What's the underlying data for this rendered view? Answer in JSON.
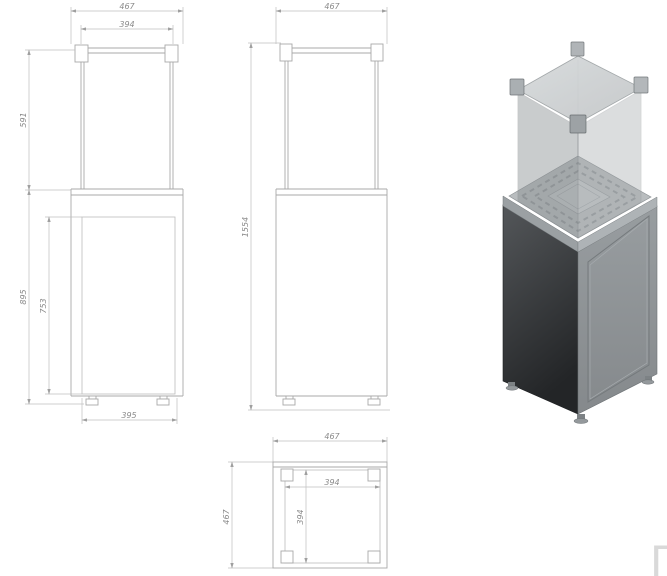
{
  "drawing": {
    "front_view": {
      "width_total": "467",
      "width_glass": "394",
      "height_glass": "591",
      "height_base": "895",
      "height_door": "753",
      "width_base": "395"
    },
    "side_view": {
      "width_total": "467",
      "height_total": "1554"
    },
    "plan_view": {
      "width_total": "467",
      "depth_total": "467",
      "width_inner": "394",
      "depth_inner": "394"
    }
  },
  "watermark": {
    "glyph": "Γ"
  },
  "colors": {
    "background": "#ffffff",
    "line_body": "#a8a8a8",
    "line_dim": "#bfbfbf",
    "dim_text": "#8a8a8a",
    "watermark": "#d9d9d9",
    "render_dark_face_top": "#54575a",
    "render_dark_face_bottom": "#232527",
    "render_light_face": "#8e9396",
    "render_top_band": "#a9aeb1",
    "render_deck": "#b9bdbf",
    "render_lid": "#cdd0d2",
    "render_connector": "#aaafb2",
    "render_glass_edge": "#7e8386"
  }
}
